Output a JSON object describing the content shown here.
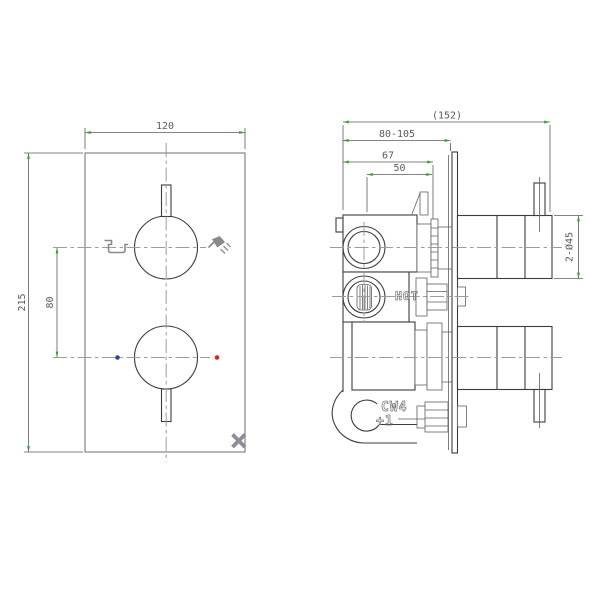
{
  "front_view": {
    "dims": {
      "width": "120",
      "height": "215",
      "knob_spacing": "80"
    }
  },
  "side_view": {
    "dims": {
      "overall_depth": "(152)",
      "wall_adjust_range": "80-105",
      "body_depth": "67",
      "port_depth": "50",
      "knob_diameter": "2-Ø45"
    },
    "labels": {
      "hot_inlet": "HOT",
      "cast_mark_line1": "CW4",
      "cast_mark_line2": "+1"
    }
  },
  "colors": {
    "line": "#3c3c3c",
    "detail": "#5f5f5f",
    "plate": "#6e6e6e",
    "centerline": "#9c9c9c",
    "dim": "#5a5a5a",
    "arrow": "#3aa035",
    "label": "#777777",
    "icon": "#8a8a8a",
    "brand": "#8b9096",
    "hot_dot": "#e32119",
    "cold_dot": "#2747b0"
  }
}
